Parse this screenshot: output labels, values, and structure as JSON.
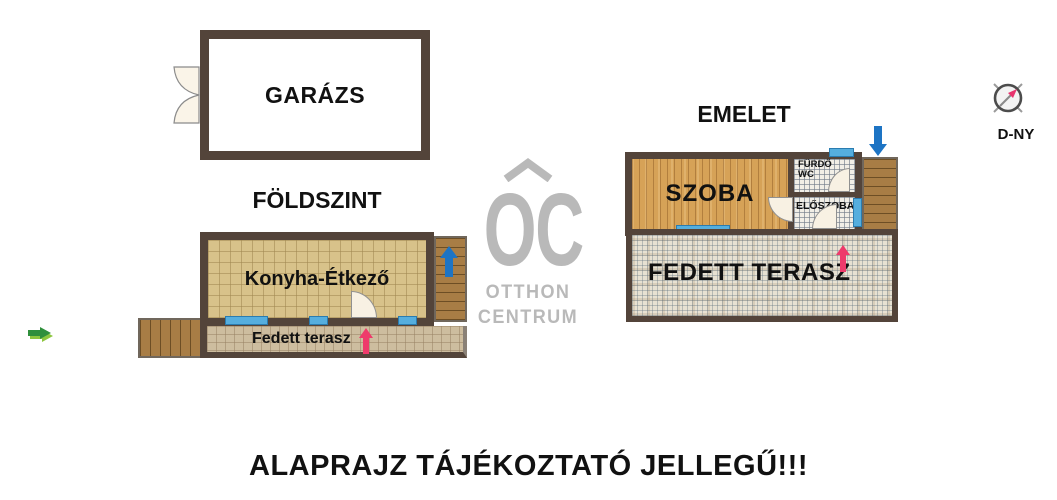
{
  "disclaimer": "ALAPRAJZ TÁJÉKOZTATÓ JELLEGŰ!!!",
  "compass": {
    "label": "D-NY"
  },
  "watermark": {
    "monogram": "OC",
    "name_line1": "OTTHON",
    "name_line2": "CENTRUM"
  },
  "ground_floor": {
    "title": "FÖLDSZINT",
    "garage_label": "GARÁZS",
    "kitchen_label": "Konyha-Étkező",
    "terrace_label": "Fedett terasz"
  },
  "upper_floor": {
    "title": "EMELET",
    "room_label": "SZOBA",
    "bathroom_label_line1": "FÜRDŐ",
    "bathroom_label_line2": "WC",
    "hallway_label": "ELŐSZOBA",
    "terrace_label": "FEDETT TERASZ"
  },
  "colors": {
    "wall_brown": "#53443a",
    "window_blue": "#55aede",
    "stair_arrow_blue": "#1d74c4",
    "entrance_arrow_pink": "#ee3a6b",
    "direction_arrow_green_dark": "#2f8f3c",
    "direction_arrow_green_light": "#8dc63f",
    "watermark_grey": "#b9b9b9",
    "kitchen_tile": "#d8c28a",
    "ground_terrace_paver": "#cdbd9f",
    "upper_terrace_tile": "#e7e1d2",
    "bathroom_tile": "#f1eee6",
    "room_wood": "#d6a257",
    "deck_wood": "#a87d45",
    "door_leaf": "#f8f1e3"
  }
}
